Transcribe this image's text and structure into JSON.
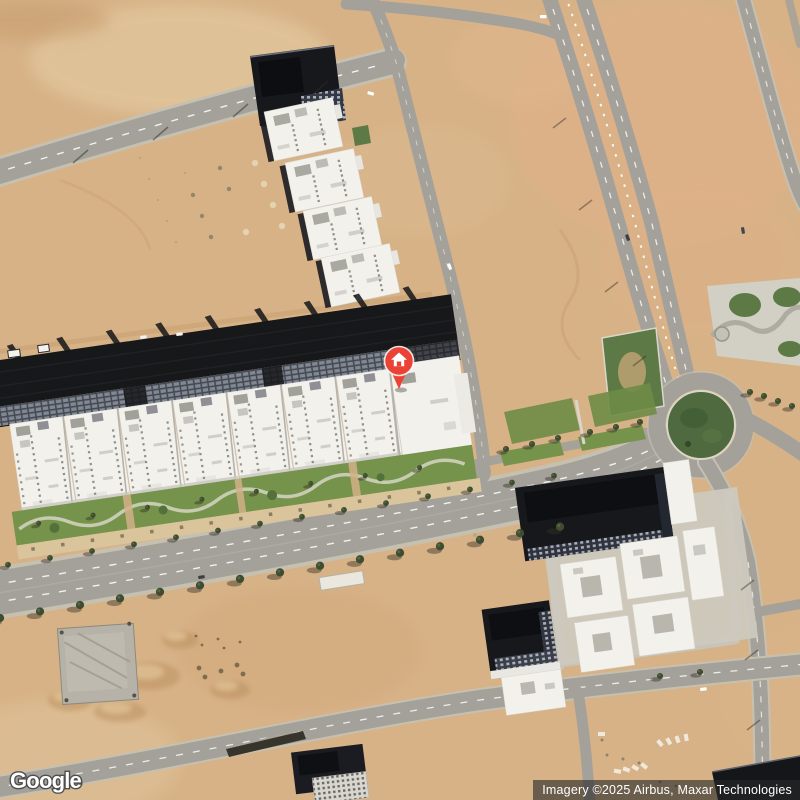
{
  "map": {
    "view_type": "satellite",
    "provider": "Google",
    "attribution": "Imagery ©2025 Airbus, Maxar Technologies",
    "marker": {
      "icon": "home",
      "shape": "circle-pin"
    },
    "colors": {
      "sand": "#d7b287",
      "sandLight": "#e7cfa6",
      "sandPink": "#e0b189",
      "road": "#a3a19a",
      "roadLight": "#c6c0b0",
      "concrete": "#c8c4b9",
      "lawn": "#75934b",
      "green": "#5d7a46",
      "greenDark": "#4e6a3e",
      "building": "#f2f1ec",
      "buildingDark": "#17181c",
      "marker": "#EA4335"
    }
  }
}
